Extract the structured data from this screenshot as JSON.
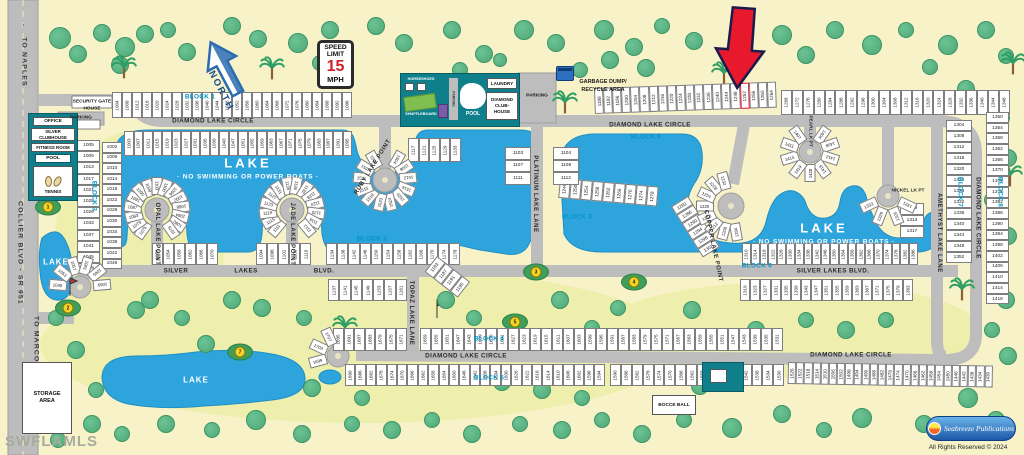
{
  "title_watermark": "SWFLAMLS",
  "copyright": "All Rights Reserved © 2024",
  "publisher": "Seabreeze Publications",
  "highlight_lot": "1252",
  "signs": {
    "speed_l1": "SPEED",
    "speed_l2": "LIMIT",
    "speed_value": "15",
    "speed_unit": "MPH",
    "north": "NORTH"
  },
  "amenities": {
    "security_l1": "SECURITY GATE",
    "security_l2": "HOUSE",
    "parking_gate": "PARKING",
    "office": "OFFICE",
    "clubhouse_l1": "SILVER",
    "clubhouse_l2": "CLUBHOUSE",
    "fitness": "FITNESS ROOM",
    "pool": "POOL",
    "tennis": "TENNIS",
    "horseshoes": "HORSESHOES",
    "shuffleboard": "SHUFFLEBOARD",
    "parking_strip": "PARKING",
    "pool2": "POOL",
    "laundry": "LAUNDRY",
    "diamond_l1": "DIAMOND",
    "diamond_l2": "CLUB-",
    "diamond_l3": "HOUSE",
    "parking_club": "PARKING",
    "garbage_l1": "GARBAGE DUMP/",
    "garbage_l2": "RECYCLE AREA",
    "bocce": "BOCCE BALL",
    "storage": "STORAGE AREA"
  },
  "labels": [
    {
      "t": "DIAMOND LAKE CIRCLE",
      "x": 213,
      "y": 121,
      "r": 0,
      "c": "street"
    },
    {
      "t": "DIAMOND LAKE CIRCLE",
      "x": 650,
      "y": 125,
      "r": 0,
      "c": "street"
    },
    {
      "t": "DIAMOND LAKE CIRCLE",
      "x": 978,
      "y": 218,
      "r": 90,
      "c": "street"
    },
    {
      "t": "DIAMOND LAKE CIRCLE",
      "x": 466,
      "y": 356,
      "r": 0,
      "c": "street"
    },
    {
      "t": "DIAMOND LAKE CIRCLE",
      "x": 851,
      "y": 355,
      "r": 0,
      "c": "street"
    },
    {
      "t": "SILVER",
      "x": 176,
      "y": 271,
      "r": 0,
      "c": "street"
    },
    {
      "t": "LAKES",
      "x": 246,
      "y": 271,
      "r": 0,
      "c": "street"
    },
    {
      "t": "BLVD.",
      "x": 324,
      "y": 271,
      "r": 0,
      "c": "street"
    },
    {
      "t": "SILVER LAKES BLVD.",
      "x": 833,
      "y": 271,
      "r": 0,
      "c": "street"
    },
    {
      "t": "OPAL LAKE POINT",
      "x": 157,
      "y": 234,
      "r": 90,
      "c": "street-v"
    },
    {
      "t": "JADE LAKE POINT",
      "x": 292,
      "y": 234,
      "r": 90,
      "c": "street-v"
    },
    {
      "t": "RUBY LAKE POINT",
      "x": 373,
      "y": 167,
      "r": -58,
      "c": "street-v"
    },
    {
      "t": "PLATINUM LAKE LANE",
      "x": 535,
      "y": 194,
      "r": 90,
      "c": "street-v"
    },
    {
      "t": "TOPAZ LAKE LANE",
      "x": 411,
      "y": 313,
      "r": 90,
      "c": "street-v"
    },
    {
      "t": "COPPER LAKE POINT",
      "x": 713,
      "y": 246,
      "r": 78,
      "c": "street-v"
    },
    {
      "t": "AMETHYST LAKE LANE",
      "x": 939,
      "y": 233,
      "r": 90,
      "c": "street-v"
    },
    {
      "t": "PEARL LK PT",
      "x": 810,
      "y": 131,
      "r": 90,
      "c": "street-vs"
    },
    {
      "t": "NICKEL LK PT",
      "x": 908,
      "y": 191,
      "r": 0,
      "c": "street-vs"
    },
    {
      "t": "COLLIER BLVD - SR 951",
      "x": 20,
      "y": 253,
      "r": 90,
      "c": "road-v"
    },
    {
      "t": "TO NAPLES",
      "x": 24,
      "y": 62,
      "r": 90,
      "c": "road-v"
    },
    {
      "t": "TO MARCO ISLAND",
      "x": 36,
      "y": 357,
      "r": 90,
      "c": "road-v"
    },
    {
      "t": "↑",
      "x": 24,
      "y": 26,
      "r": 0,
      "c": "road-v"
    },
    {
      "t": "↓",
      "x": 36,
      "y": 402,
      "r": 0,
      "c": "road-v"
    },
    {
      "t": "BLOCK 1",
      "x": 200,
      "y": 97,
      "r": 0,
      "c": "block"
    },
    {
      "t": "BLOCK 3",
      "x": 94,
      "y": 196,
      "r": 90,
      "c": "block"
    },
    {
      "t": "BLOCK 2",
      "x": 372,
      "y": 239,
      "r": 0,
      "c": "block"
    },
    {
      "t": "BLOCK 3",
      "x": 577,
      "y": 217,
      "r": 0,
      "c": "block"
    },
    {
      "t": "BLOCK 4",
      "x": 489,
      "y": 339,
      "r": 0,
      "c": "block"
    },
    {
      "t": "BLOCK 5",
      "x": 489,
      "y": 378,
      "r": 0,
      "c": "block"
    },
    {
      "t": "BLOCK 6",
      "x": 646,
      "y": 137,
      "r": 0,
      "c": "block"
    },
    {
      "t": "BLOCK 6",
      "x": 757,
      "y": 266,
      "r": 0,
      "c": "block"
    },
    {
      "t": "BLOCK 7",
      "x": 960,
      "y": 192,
      "r": 90,
      "c": "block"
    },
    {
      "t": "BLOCK 8",
      "x": 1000,
      "y": 192,
      "r": 90,
      "c": "block"
    },
    {
      "t": "LAKE",
      "x": 248,
      "y": 163,
      "r": 0,
      "c": "lake-t"
    },
    {
      "t": "· NO SWIMMING OR POWER BOATS ·",
      "x": 248,
      "y": 177,
      "r": 0,
      "c": "lake-s"
    },
    {
      "t": "LAKE",
      "x": 824,
      "y": 228,
      "r": 0,
      "c": "lake-t"
    },
    {
      "t": "· NO SWIMMING OR POWER BOATS ·",
      "x": 824,
      "y": 242,
      "r": 0,
      "c": "lake-s"
    },
    {
      "t": "LAKE",
      "x": 56,
      "y": 262,
      "r": 0,
      "c": "lake-m"
    },
    {
      "t": "LAKE",
      "x": 196,
      "y": 380,
      "r": 0,
      "c": "lake-m"
    },
    {
      "t": "PARKING",
      "x": 81,
      "y": 118,
      "r": 0,
      "c": "tinylab"
    },
    {
      "t": "PARKING",
      "x": 537,
      "y": 96,
      "r": 0,
      "c": "tinylab"
    },
    {
      "t": "GARBAGE DUMP/",
      "x": 603,
      "y": 82,
      "r": 0,
      "c": "tinylab-b"
    },
    {
      "t": "RECYCLE AREA",
      "x": 603,
      "y": 90,
      "r": 0,
      "c": "tinylab-b"
    }
  ],
  "lot_rows": [
    {
      "id": "b1-north",
      "x": 112,
      "y": 92,
      "bw": 10,
      "bh": 26,
      "rot": 0,
      "from": 1004,
      "to": 1096,
      "step": 4
    },
    {
      "id": "b1-south",
      "x": 124,
      "y": 131,
      "bw": 9.5,
      "bh": 25,
      "rot": 0,
      "from": 1003,
      "to": 1095,
      "step": 4
    },
    {
      "id": "north-east-1",
      "x": 594,
      "y": 88,
      "bw": 9.1,
      "bh": 26,
      "rot": -2,
      "from": 1188,
      "to": 1264,
      "step": 4
    },
    {
      "id": "north-east-2",
      "x": 781,
      "y": 90,
      "bw": 10.9,
      "bh": 25,
      "rot": 0,
      "from": 1268,
      "to": 1348,
      "step": 4
    },
    {
      "id": "silver-north-east",
      "x": 742,
      "y": 243,
      "bw": 8.8,
      "bh": 22,
      "rot": 0,
      "from": 1310,
      "to": 1386,
      "step": 4
    },
    {
      "id": "silver-south-east",
      "x": 740,
      "y": 279,
      "bw": 10.2,
      "bh": 22,
      "rot": 0,
      "from": 1319,
      "to": 1383,
      "step": 4
    },
    {
      "id": "silver-south-west",
      "x": 328,
      "y": 279,
      "bw": 11.3,
      "bh": 22,
      "rot": 0,
      "from": 1137,
      "to": 1161,
      "step": 4
    },
    {
      "id": "silver-north-w1",
      "x": 152,
      "y": 243,
      "bw": 11,
      "bh": 22,
      "rot": 0,
      "from": 1050,
      "to": 1070,
      "step": 4
    },
    {
      "id": "silver-north-w2",
      "x": 256,
      "y": 243,
      "bw": 11,
      "bh": 22,
      "rot": 0,
      "from": 1094,
      "to": 1110,
      "step": 4
    },
    {
      "id": "block2",
      "x": 326,
      "y": 243,
      "bw": 11.2,
      "bh": 22,
      "rot": 0,
      "from": 1134,
      "to": 1178,
      "step": 4
    },
    {
      "id": "block4-west",
      "x": 333,
      "y": 328,
      "bw": 10.5,
      "bh": 23,
      "rot": 0,
      "from": 1695,
      "to": 1671,
      "step": -4
    },
    {
      "id": "block4-main",
      "x": 420,
      "y": 328,
      "bw": 11,
      "bh": 23,
      "rot": 0,
      "from": 1659,
      "to": 1531,
      "step": -4
    },
    {
      "id": "block5-west",
      "x": 345,
      "y": 364,
      "bw": 10.4,
      "bh": 22,
      "rot": 0,
      "from": 1690,
      "to": 1594,
      "step": -4
    },
    {
      "id": "block5-east",
      "x": 610,
      "y": 364,
      "bw": 10.9,
      "bh": 22,
      "rot": 0,
      "from": 1590,
      "to": 1530,
      "step": -4
    },
    {
      "id": "bottom-right",
      "x": 788,
      "y": 362,
      "bw": 8.2,
      "bh": 22,
      "rot": 1,
      "from": 1526,
      "to": 1430,
      "step": -4
    },
    {
      "id": "lake-south-edge",
      "x": 560,
      "y": 178,
      "bw": 11,
      "bh": 20,
      "rot": 5,
      "from": 1246,
      "to": 1278,
      "step": 4
    },
    {
      "id": "copper-east",
      "x": 688,
      "y": 196,
      "bw": 10,
      "bh": 20,
      "rot": 58,
      "from": 1282,
      "to": 1302,
      "step": 4
    },
    {
      "id": "ruby-east-row",
      "x": 408,
      "y": 138,
      "bw": 10.5,
      "bh": 24,
      "rot": 0,
      "from": 1117,
      "to": 1133,
      "step": 4
    },
    {
      "id": "topaz-top",
      "x": 437,
      "y": 256,
      "bw": 10.5,
      "bh": 20,
      "rot": 38,
      "from": 1183,
      "to": 1195,
      "step": 4
    }
  ],
  "lot_cols": [
    {
      "id": "block7",
      "x": 946,
      "y": 120,
      "w": 26,
      "bh": 11,
      "from": 1304,
      "to": 1352,
      "step": 4
    },
    {
      "id": "block8",
      "x": 986,
      "y": 112,
      "w": 23,
      "bh": 10.7,
      "from": 1350,
      "to": 1418,
      "step": 4
    },
    {
      "id": "left-outer",
      "x": 77,
      "y": 140,
      "w": 23,
      "bh": 11.2,
      "from": 1005,
      "to": 1049,
      "step": 4
    },
    {
      "id": "left-inner",
      "x": 102,
      "y": 142,
      "w": 20,
      "bh": 10.6,
      "from": 1002,
      "to": 1046,
      "step": 4
    },
    {
      "id": "platinum-west",
      "x": 505,
      "y": 147,
      "w": 26,
      "bh": 12.5,
      "from": 1103,
      "to": 1111,
      "step": 4
    },
    {
      "id": "platinum-east",
      "x": 553,
      "y": 147,
      "w": 26,
      "bh": 12.5,
      "from": 1104,
      "to": 1112,
      "step": 4
    },
    {
      "id": "nickel-east",
      "x": 900,
      "y": 203,
      "w": 24,
      "bh": 11.5,
      "from": 1309,
      "to": 1317,
      "step": 4
    }
  ],
  "culdesacs": [
    {
      "id": "opal",
      "cx": 157,
      "cy": 210,
      "r": 24,
      "a0": 125,
      "a1": 415,
      "lots": [
        1075,
        1079,
        1083,
        1087,
        1091,
        1095,
        1099,
        1103,
        1100,
        1096,
        1092,
        1088,
        1084,
        1080,
        1076
      ]
    },
    {
      "id": "jade",
      "cx": 292,
      "cy": 210,
      "r": 24,
      "a0": 130,
      "a1": 410,
      "lots": [
        1111,
        1115,
        1119,
        1123,
        1127,
        1131,
        1135,
        1136,
        1132,
        1128,
        1124,
        1120,
        1116,
        1112
      ]
    },
    {
      "id": "ruby",
      "cx": 385,
      "cy": 180,
      "r": 23,
      "a0": -60,
      "a1": 240,
      "lots": [
        1504,
        1508,
        1512,
        1516,
        1520,
        1524,
        1523,
        1519,
        1515,
        1511,
        1507,
        1503
      ]
    },
    {
      "id": "pearl",
      "cx": 810,
      "cy": 152,
      "r": 21,
      "a0": -55,
      "a1": 235,
      "lots": [
        1404,
        1408,
        1412,
        1416,
        1420,
        1419,
        1415,
        1411,
        1407
      ]
    },
    {
      "id": "nickel",
      "cx": 888,
      "cy": 196,
      "r": 21,
      "a0": 25,
      "a1": 155,
      "lots": [
        1321,
        1325,
        1329,
        1333
      ]
    },
    {
      "id": "copper",
      "cx": 731,
      "cy": 206,
      "r": 26,
      "a0": 80,
      "a1": 255,
      "lots": [
        1204,
        1208,
        1212,
        1216,
        1220,
        1224,
        1228,
        1232
      ]
    },
    {
      "id": "silver-west-end",
      "cx": 80,
      "cy": 287,
      "r": 22,
      "a0": 185,
      "a1": 355,
      "lots": [
        1049,
        1053,
        1057,
        1061,
        1065,
        1069
      ]
    },
    {
      "id": "diamond-west-end",
      "cx": 338,
      "cy": 356,
      "r": 21,
      "a0": 165,
      "a1": 245,
      "lots": [
        1699,
        1703,
        1707
      ]
    }
  ],
  "golf_holes": [
    {
      "n": "1",
      "x": 48,
      "y": 207
    },
    {
      "n": "2",
      "x": 68,
      "y": 308
    },
    {
      "n": "3",
      "x": 536,
      "y": 272
    },
    {
      "n": "4",
      "x": 634,
      "y": 282
    },
    {
      "n": "5",
      "x": 515,
      "y": 322
    },
    {
      "n": "6",
      "x": 437,
      "y": 341
    },
    {
      "n": "7",
      "x": 240,
      "y": 352
    }
  ],
  "trees": [
    [
      60,
      38,
      10
    ],
    [
      78,
      54,
      8
    ],
    [
      102,
      33,
      8
    ],
    [
      125,
      47,
      9
    ],
    [
      145,
      34,
      8
    ],
    [
      168,
      30,
      7
    ],
    [
      187,
      52,
      8
    ],
    [
      232,
      26,
      8
    ],
    [
      258,
      39,
      8
    ],
    [
      298,
      43,
      9
    ],
    [
      330,
      30,
      8
    ],
    [
      376,
      26,
      8
    ],
    [
      404,
      43,
      8
    ],
    [
      452,
      30,
      8
    ],
    [
      484,
      54,
      8
    ],
    [
      524,
      30,
      9
    ],
    [
      556,
      43,
      8
    ],
    [
      604,
      30,
      9
    ],
    [
      634,
      47,
      8
    ],
    [
      662,
      26,
      7
    ],
    [
      694,
      41,
      8
    ],
    [
      782,
      35,
      9
    ],
    [
      806,
      55,
      8
    ],
    [
      835,
      30,
      8
    ],
    [
      872,
      45,
      9
    ],
    [
      906,
      30,
      7
    ],
    [
      948,
      45,
      9
    ],
    [
      986,
      30,
      8
    ],
    [
      1006,
      56,
      7
    ],
    [
      120,
      65,
      8
    ],
    [
      320,
      63,
      7
    ],
    [
      646,
      68,
      8
    ],
    [
      930,
      67,
      7
    ],
    [
      966,
      89,
      8
    ],
    [
      1002,
      118,
      7
    ],
    [
      1008,
      158,
      8
    ],
    [
      992,
      200,
      7
    ],
    [
      1008,
      236,
      8
    ],
    [
      996,
      264,
      7
    ],
    [
      1006,
      300,
      8
    ],
    [
      992,
      330,
      7
    ],
    [
      1008,
      356,
      8
    ],
    [
      968,
      398,
      9
    ],
    [
      996,
      420,
      8
    ],
    [
      924,
      424,
      8
    ],
    [
      862,
      418,
      9
    ],
    [
      824,
      430,
      7
    ],
    [
      782,
      414,
      8
    ],
    [
      732,
      428,
      9
    ],
    [
      684,
      420,
      7
    ],
    [
      642,
      434,
      8
    ],
    [
      602,
      420,
      7
    ],
    [
      562,
      430,
      8
    ],
    [
      520,
      424,
      7
    ],
    [
      472,
      434,
      8
    ],
    [
      432,
      420,
      7
    ],
    [
      392,
      430,
      8
    ],
    [
      352,
      424,
      7
    ],
    [
      302,
      434,
      8
    ],
    [
      256,
      420,
      9
    ],
    [
      212,
      430,
      7
    ],
    [
      166,
      424,
      8
    ],
    [
      122,
      434,
      7
    ],
    [
      92,
      424,
      8
    ],
    [
      58,
      440,
      7
    ],
    [
      150,
      300,
      8
    ],
    [
      182,
      318,
      7
    ],
    [
      262,
      308,
      8
    ],
    [
      304,
      318,
      7
    ],
    [
      446,
      300,
      8
    ],
    [
      474,
      318,
      7
    ],
    [
      560,
      300,
      8
    ],
    [
      592,
      328,
      7
    ],
    [
      618,
      308,
      7
    ],
    [
      658,
      338,
      9
    ],
    [
      692,
      310,
      8
    ],
    [
      542,
      390,
      8
    ],
    [
      582,
      398,
      7
    ],
    [
      502,
      382,
      8
    ],
    [
      362,
      398,
      7
    ],
    [
      312,
      388,
      8
    ],
    [
      96,
      390,
      7
    ],
    [
      76,
      350,
      8
    ],
    [
      56,
      318,
      7
    ],
    [
      136,
      310,
      8
    ],
    [
      232,
      300,
      8
    ],
    [
      206,
      344,
      8
    ],
    [
      756,
      330,
      8
    ],
    [
      806,
      320,
      7
    ],
    [
      846,
      330,
      8
    ],
    [
      886,
      320,
      7
    ],
    [
      700,
      386,
      8
    ],
    [
      610,
      60,
      8
    ],
    [
      580,
      70,
      7
    ],
    [
      460,
      70,
      7
    ],
    [
      500,
      60,
      6
    ]
  ],
  "palms": [
    [
      124,
      80
    ],
    [
      272,
      81
    ],
    [
      565,
      115
    ],
    [
      724,
      86
    ],
    [
      1013,
      76
    ],
    [
      1010,
      188
    ],
    [
      345,
      340
    ],
    [
      962,
      302
    ]
  ],
  "colors": {
    "background": "#F7F2C8",
    "fairway": "#EEEFAC",
    "lake": "#2EA4DC",
    "road": "#BDBDBD",
    "building_teal": "#0F7F8C",
    "block_label": "#0095C8",
    "arrow_red": "#E8192C",
    "tree": "#57B383"
  }
}
